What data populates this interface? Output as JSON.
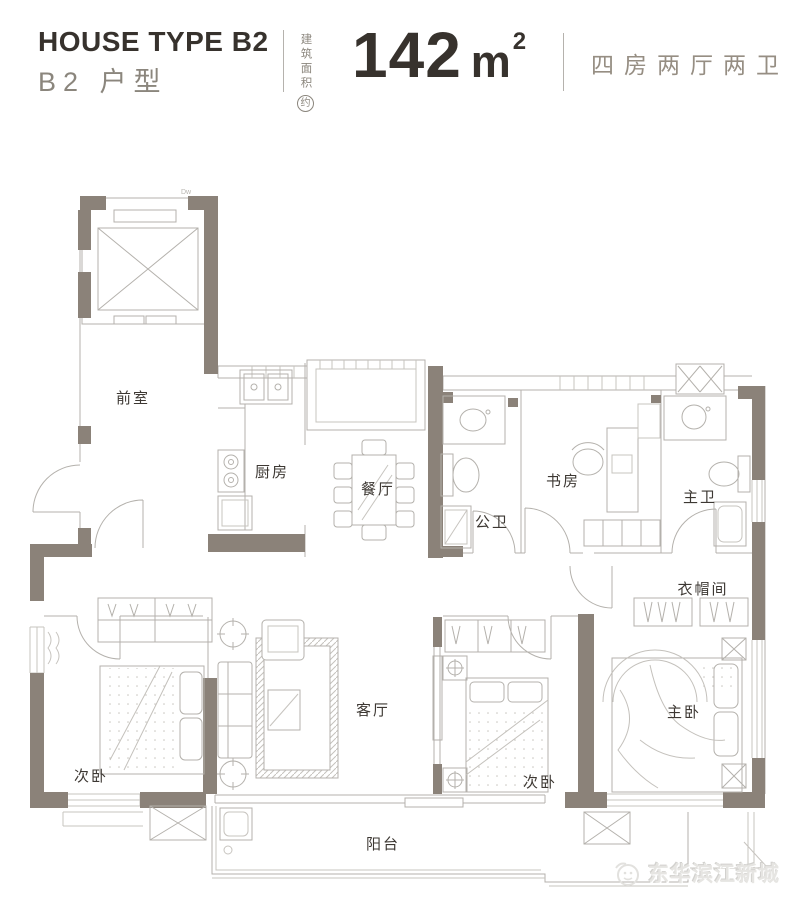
{
  "header": {
    "title_en": "HOUSE TYPE B2",
    "title_cn": "B2 户型",
    "area_label_vertical": "建筑面积",
    "area_label_circled": "约",
    "area_value": "142",
    "area_unit": "m",
    "area_exponent": "2",
    "layout_spec": "四房两厅两卫"
  },
  "floorplan": {
    "tiny_note": "Dw",
    "rooms": [
      {
        "id": "front-room",
        "label": "前室"
      },
      {
        "id": "kitchen",
        "label": "厨房"
      },
      {
        "id": "dining-room",
        "label": "餐厅"
      },
      {
        "id": "guest-bathroom",
        "label": "公卫"
      },
      {
        "id": "study",
        "label": "书房"
      },
      {
        "id": "master-bathroom",
        "label": "主卫"
      },
      {
        "id": "walk-in-closet",
        "label": "衣帽间"
      },
      {
        "id": "second-bedroom-left",
        "label": "次卧"
      },
      {
        "id": "living-room",
        "label": "客厅"
      },
      {
        "id": "second-bedroom-middle",
        "label": "次卧"
      },
      {
        "id": "master-bedroom",
        "label": "主卧"
      },
      {
        "id": "balcony",
        "label": "阳台"
      }
    ]
  },
  "watermark": {
    "brand": "东华滨江新城"
  },
  "colors": {
    "wall": "#8b8279",
    "thin_line": "#b4b1ac",
    "light_line": "#c7c4bf",
    "text_dark": "#37322d",
    "text_gray": "#8b867d",
    "spec_text": "#968e83",
    "watermark_text": "#e6e5e2"
  }
}
